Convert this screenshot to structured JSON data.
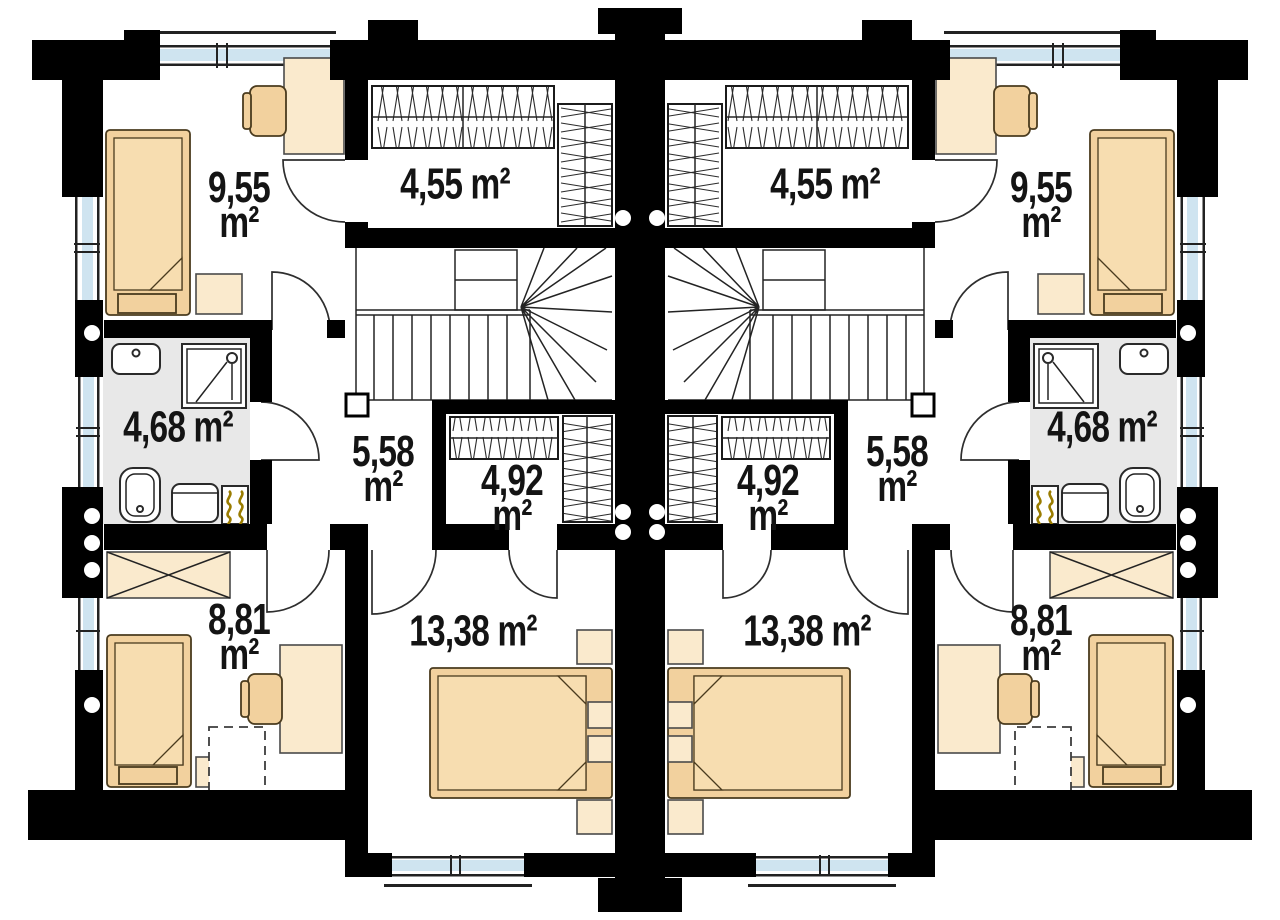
{
  "colors": {
    "wall": "#000000",
    "line": "#222222",
    "bed-tan": "#f2d19e",
    "mattress-tan": "#f7ddb0",
    "furniture-cream": "#faeacd",
    "bath-floor": "#e8e8e8",
    "window-glass": "#cfe4f0",
    "radiator-accent": "#9a7c00",
    "label-text": "#141414"
  },
  "rooms": [
    {
      "id": "bedroom-upper",
      "area": "9,55",
      "unit": "m²"
    },
    {
      "id": "wardrobe-upper",
      "area": "4,55",
      "unit": "m²"
    },
    {
      "id": "bathroom",
      "area": "4,68",
      "unit": "m²"
    },
    {
      "id": "hall-stairs",
      "area": "5,58",
      "unit": "m²"
    },
    {
      "id": "walk-in-closet",
      "area": "4,92",
      "unit": "m²"
    },
    {
      "id": "bedroom-lower",
      "area": "8,81",
      "unit": "m²"
    },
    {
      "id": "bedroom-main",
      "area": "13,38",
      "unit": "m²"
    }
  ]
}
